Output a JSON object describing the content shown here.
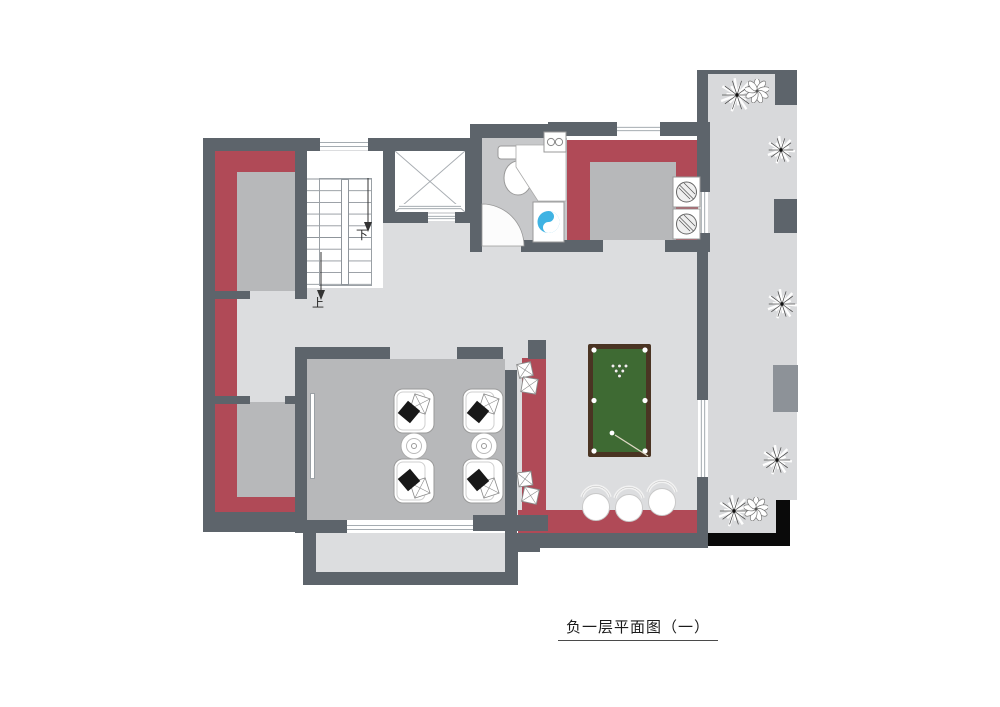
{
  "title": {
    "text": "负一层平面图（一）"
  },
  "stairs": {
    "down_label": "下",
    "up_label": "上"
  },
  "rooms": {
    "media_room_features": [
      "armchair",
      "armchair",
      "armchair",
      "armchair",
      "side-table",
      "side-table",
      "projection-screen"
    ],
    "bathroom_features": [
      "toilet",
      "shower-enclosure",
      "washing-machine",
      "basin"
    ],
    "billiard_features": [
      "pool-table",
      "bench-cushions",
      "bar-stools"
    ],
    "courtyard_features": [
      "plants",
      "pillars"
    ]
  },
  "colors": {
    "wall": "#5d646b",
    "red_wall": "#b04a57",
    "floor_light": "#dcdddf",
    "floor_medium": "#b7b8ba",
    "floor_bath": "#c7c8ca",
    "floor_outdoor": "#d8d9db",
    "pool_felt": "#3e6a33",
    "pool_frame": "#4a3423",
    "washer_blue": "#3fb3e3",
    "pillar_light": "#8d9298",
    "black": "#0a0a0a",
    "window_line": "#98a0a6"
  }
}
